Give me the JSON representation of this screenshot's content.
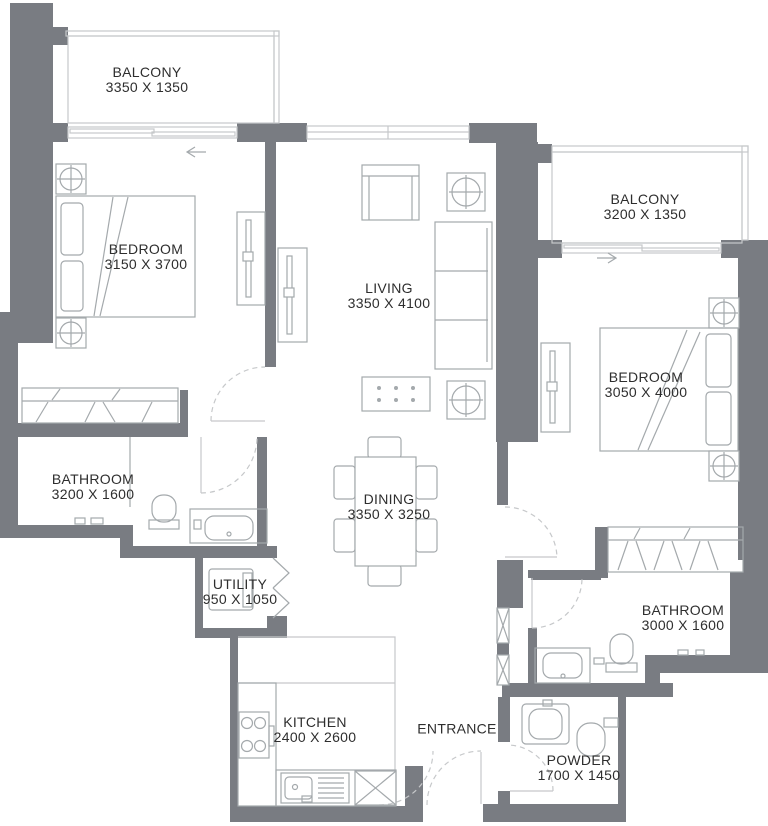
{
  "plan": {
    "type": "apartment-floor-plan",
    "colors": {
      "wall": "#797c82",
      "line": "#a4a9ac",
      "light": "#c6c8ca",
      "text": "#2e2e2e",
      "bg": "#ffffff"
    }
  },
  "rooms": [
    {
      "name": "BALCONY",
      "dims": "3350 X 1350",
      "x": 147,
      "y": 80
    },
    {
      "name": "BEDROOM",
      "dims": "3150 X 3700",
      "x": 146,
      "y": 257
    },
    {
      "name": "LIVING",
      "dims": "3350 X 4100",
      "x": 389,
      "y": 296
    },
    {
      "name": "BALCONY",
      "dims": "3200 X 1350",
      "x": 645,
      "y": 207
    },
    {
      "name": "BEDROOM",
      "dims": "3050 X 4000",
      "x": 646,
      "y": 385
    },
    {
      "name": "BATHROOM",
      "dims": "3200 X 1600",
      "x": 93,
      "y": 487
    },
    {
      "name": "DINING",
      "dims": "3350 X 3250",
      "x": 389,
      "y": 507
    },
    {
      "name": "UTILITY",
      "dims": "950 X 1050",
      "x": 240,
      "y": 592
    },
    {
      "name": "BATHROOM",
      "dims": "3000 X 1600",
      "x": 683,
      "y": 618
    },
    {
      "name": "KITCHEN",
      "dims": "2400 X 2600",
      "x": 315,
      "y": 730
    },
    {
      "name": "ENTRANCE",
      "dims": "",
      "x": 457,
      "y": 729
    },
    {
      "name": "POWDER",
      "dims": "1700 X 1450",
      "x": 579,
      "y": 768
    }
  ]
}
